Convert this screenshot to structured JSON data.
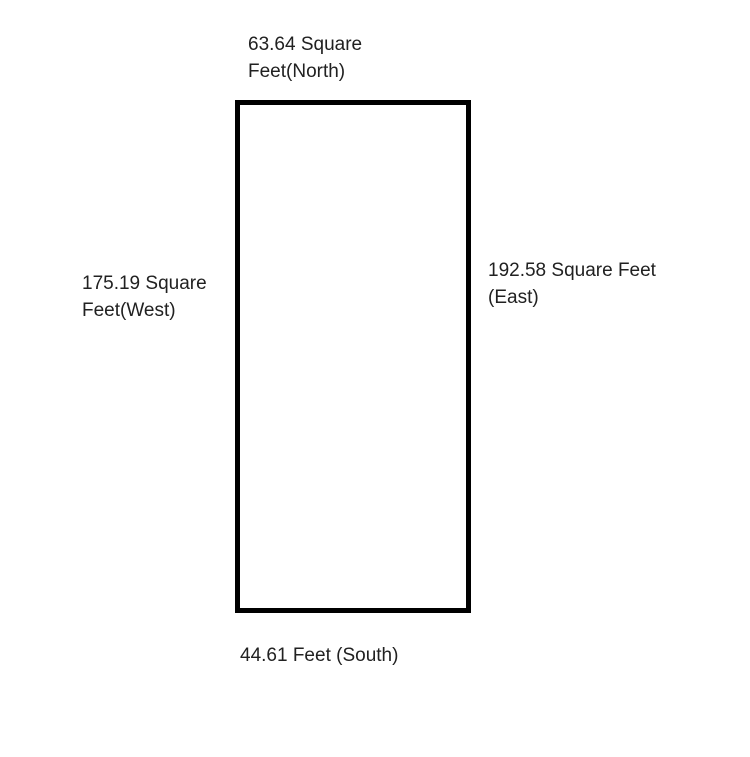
{
  "diagram": {
    "type": "parcel-dimension-diagram",
    "labels": {
      "north": "63.64 Square Feet(North)",
      "west": "175.19 Square Feet(West)",
      "east": "192.58 Square Feet (East)",
      "south": "44.61 Feet (South)"
    },
    "shape": {
      "kind": "rectangle",
      "border_color": "#000000",
      "border_width_px": 5,
      "fill": "#ffffff"
    },
    "colors": {
      "background": "#ffffff",
      "text": "#212121"
    }
  }
}
